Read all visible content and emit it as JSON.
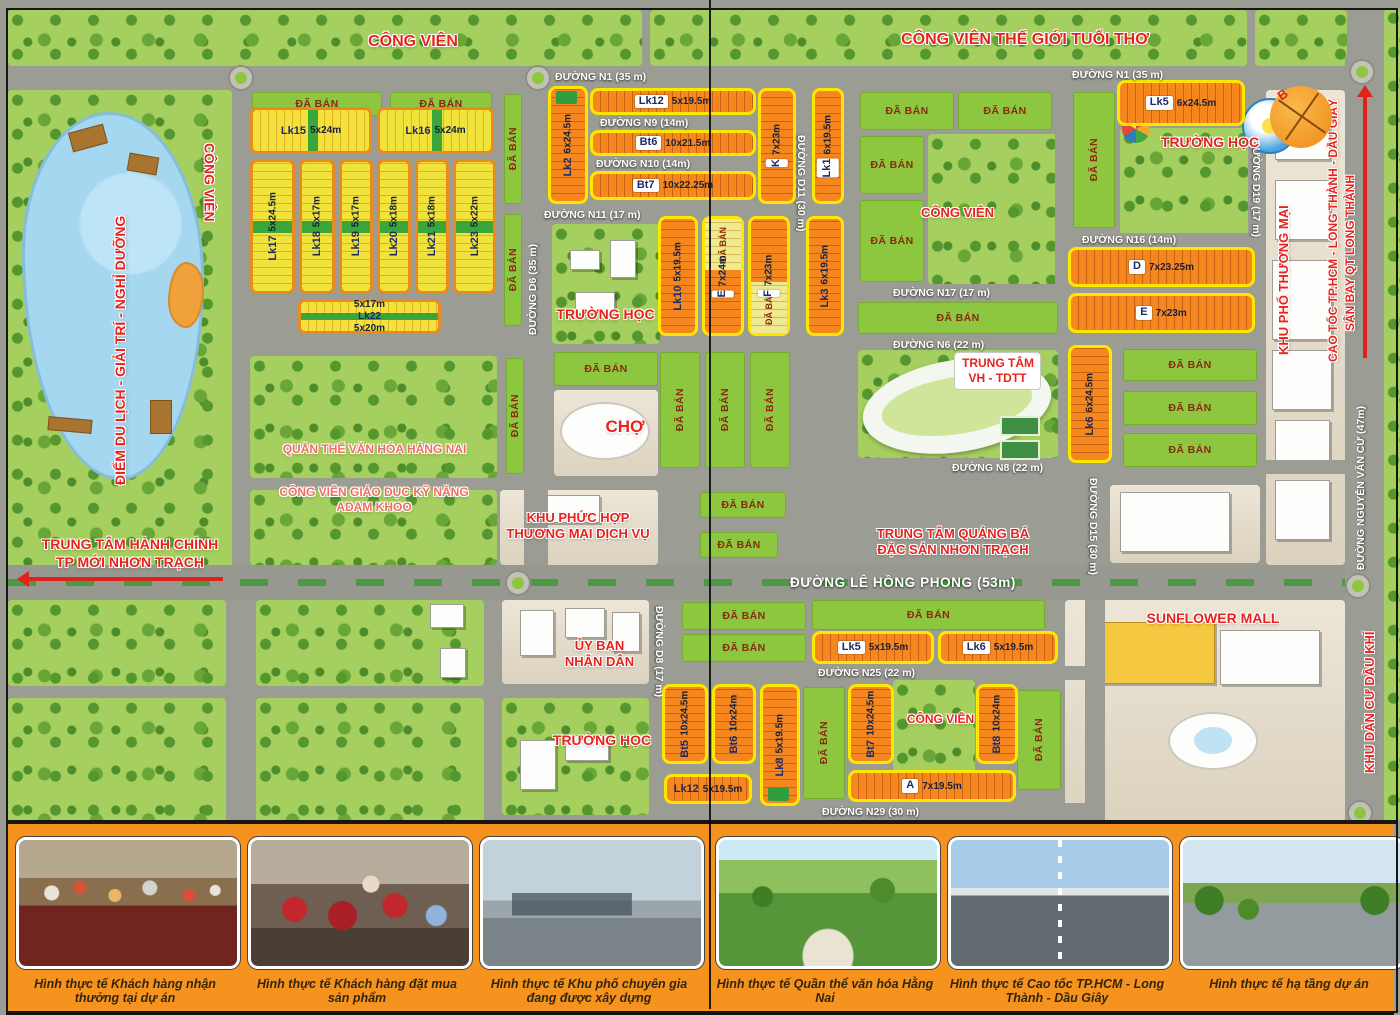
{
  "legend": {
    "sold": "ĐÃ BÁN"
  },
  "compass": {
    "letter": "B"
  },
  "colors": {
    "road": "#9b9c93",
    "sold_green": "#8dc63f",
    "lot_orange": "#f6871f",
    "lot_yellow": "#f2e23c",
    "border_yellow": "#ffe600",
    "border_orange": "#e98c1d",
    "label_red": "#e8231d",
    "water": "#a5d7f0",
    "strip_orange": "#f6921e"
  },
  "roads": [
    {
      "id": "n1",
      "label": "ĐƯỜNG N1 (35 m)",
      "x": 8,
      "y": 66,
      "w": 1337,
      "h": 24,
      "lx": 555,
      "ly": 71,
      "l2x": 1072,
      "l2y": 69
    },
    {
      "id": "d6",
      "label": "ĐƯỜNG D6 (35 m)",
      "x": 524,
      "y": 90,
      "w": 24,
      "h": 475,
      "lx": 527,
      "ly": 215,
      "lh": 120,
      "lvert": "up"
    },
    {
      "id": "d11-top",
      "label": "ĐƯỜNG D11 (30 m)",
      "x": 794,
      "y": 90,
      "w": 16,
      "h": 475,
      "lx": 795,
      "ly": 135,
      "lh": 115,
      "lvert": "down"
    },
    {
      "id": "left-v",
      "x": 232,
      "y": 66,
      "w": 18,
      "h": 534
    },
    {
      "id": "mid-v",
      "x": 845,
      "y": 90,
      "w": 13,
      "h": 475
    },
    {
      "id": "right-v1",
      "x": 1055,
      "y": 90,
      "w": 16,
      "h": 255
    },
    {
      "id": "d15",
      "label": "ĐƯỜNG D15 (30 m)",
      "x": 1085,
      "y": 345,
      "w": 20,
      "h": 255,
      "lx": 1087,
      "ly": 478,
      "lh": 112,
      "lvert": "down"
    },
    {
      "id": "d19",
      "label": "ĐƯỜNG D19 (17 m)",
      "x": 1248,
      "y": 66,
      "w": 18,
      "h": 170,
      "lx": 1250,
      "ly": 140,
      "lh": 95,
      "lvert": "down"
    },
    {
      "id": "nguyen-van-cu",
      "label": "ĐƯỜNG NGUYỄN VĂN CỪ (47m)",
      "x": 1345,
      "y": 56,
      "w": 37,
      "h": 766,
      "lx": 1355,
      "ly": 360,
      "lh": 210,
      "lvert": "up"
    },
    {
      "id": "n9",
      "label": "ĐƯỜNG N9 (14m)",
      "x": 588,
      "y": 117,
      "w": 168,
      "h": 11,
      "lx": 600,
      "ly": 117
    },
    {
      "id": "n10",
      "label": "ĐƯỜNG N10 (14m)",
      "x": 588,
      "y": 158,
      "w": 168,
      "h": 11,
      "lx": 596,
      "ly": 158
    },
    {
      "id": "n11",
      "label": "ĐƯỜNG N11 (17 m)",
      "x": 524,
      "y": 208,
      "w": 334,
      "h": 13,
      "lx": 544,
      "ly": 209
    },
    {
      "id": "n16",
      "label": "ĐƯỜNG N16 (14m)",
      "x": 1068,
      "y": 233,
      "w": 180,
      "h": 12,
      "lx": 1082,
      "ly": 234
    },
    {
      "id": "n17",
      "label": "ĐƯỜNG N17 (17 m)",
      "x": 858,
      "y": 286,
      "w": 200,
      "h": 12,
      "lx": 893,
      "ly": 287
    },
    {
      "id": "n6",
      "label": "ĐƯỜNG N6 (22 m)",
      "x": 858,
      "y": 338,
      "w": 230,
      "h": 12,
      "lx": 893,
      "ly": 339
    },
    {
      "id": "n8",
      "label": "ĐƯỜNG N8 (22 m)",
      "x": 858,
      "y": 460,
      "w": 487,
      "h": 14,
      "lx": 952,
      "ly": 462
    },
    {
      "id": "mid-h",
      "x": 232,
      "y": 478,
      "w": 626,
      "h": 12
    },
    {
      "id": "le-hong-phong",
      "label": "ĐƯỜNG LÊ HỒNG PHONG  (53m)",
      "x": 8,
      "y": 565,
      "w": 1337,
      "h": 35,
      "lx": 790,
      "ly": 575,
      "big": true
    },
    {
      "id": "n25",
      "label": "ĐƯỜNG N25 (22 m)",
      "x": 652,
      "y": 666,
      "w": 433,
      "h": 14,
      "lx": 818,
      "ly": 667
    },
    {
      "id": "n29",
      "label": "ĐƯỜNG N29 (30 m)",
      "x": 652,
      "y": 803,
      "w": 433,
      "h": 17,
      "lx": 822,
      "ly": 806
    },
    {
      "id": "d8",
      "label": "ĐƯỜNG D8 (17 m)",
      "x": 650,
      "y": 600,
      "w": 24,
      "h": 222,
      "lx": 653,
      "ly": 606,
      "lh": 100,
      "lvert": "down"
    },
    {
      "id": "bl-h",
      "x": 8,
      "y": 686,
      "w": 644,
      "h": 12
    },
    {
      "id": "bl-v1",
      "x": 230,
      "y": 600,
      "w": 16,
      "h": 222
    },
    {
      "id": "bl-v2",
      "x": 488,
      "y": 600,
      "w": 14,
      "h": 222
    },
    {
      "id": "mall-left-v",
      "x": 1085,
      "y": 600,
      "w": 20,
      "h": 222
    }
  ],
  "parks": [
    {
      "id": "top-left",
      "x": 8,
      "y": 10,
      "w": 634,
      "h": 56
    },
    {
      "id": "top-mid",
      "x": 650,
      "y": 10,
      "w": 597,
      "h": 56
    },
    {
      "id": "top-right",
      "x": 1255,
      "y": 10,
      "w": 92,
      "h": 56
    },
    {
      "id": "lake-park",
      "x": 8,
      "y": 90,
      "w": 224,
      "h": 510
    },
    {
      "id": "school-mid",
      "x": 552,
      "y": 224,
      "w": 108,
      "h": 120
    },
    {
      "id": "quan-the",
      "x": 250,
      "y": 356,
      "w": 247,
      "h": 122
    },
    {
      "id": "adam-khoo",
      "x": 250,
      "y": 490,
      "w": 247,
      "h": 75
    },
    {
      "id": "central-cong-vien",
      "x": 928,
      "y": 134,
      "w": 130,
      "h": 150
    },
    {
      "id": "school-right",
      "x": 1120,
      "y": 128,
      "w": 132,
      "h": 107
    },
    {
      "id": "vh-tdtt",
      "x": 858,
      "y": 350,
      "w": 200,
      "h": 108
    },
    {
      "id": "bl-a",
      "x": 8,
      "y": 600,
      "w": 218,
      "h": 86
    },
    {
      "id": "bl-b",
      "x": 8,
      "y": 698,
      "w": 218,
      "h": 124
    },
    {
      "id": "bl-c",
      "x": 256,
      "y": 600,
      "w": 228,
      "h": 86
    },
    {
      "id": "bl-d",
      "x": 256,
      "y": 698,
      "w": 228,
      "h": 124
    },
    {
      "id": "school-bottom",
      "x": 502,
      "y": 698,
      "w": 147,
      "h": 117
    },
    {
      "id": "cong-vien-bottom",
      "x": 893,
      "y": 680,
      "w": 82,
      "h": 92
    },
    {
      "id": "east-edge",
      "x": 1384,
      "y": 8,
      "w": 16,
      "h": 814
    }
  ],
  "plazas": [
    {
      "id": "cho",
      "x": 554,
      "y": 390,
      "w": 104,
      "h": 86
    },
    {
      "id": "khu-phuc-hop",
      "x": 500,
      "y": 490,
      "w": 158,
      "h": 75
    },
    {
      "id": "uy-ban",
      "x": 502,
      "y": 600,
      "w": 147,
      "h": 84
    },
    {
      "id": "sunflower",
      "x": 1065,
      "y": 600,
      "w": 280,
      "h": 222
    },
    {
      "id": "shophouse-strip",
      "x": 1266,
      "y": 90,
      "w": 79,
      "h": 475
    },
    {
      "id": "office-block",
      "x": 1110,
      "y": 485,
      "w": 150,
      "h": 78
    }
  ],
  "buildings": [
    {
      "x": 570,
      "y": 250,
      "w": 30,
      "h": 20
    },
    {
      "x": 610,
      "y": 240,
      "w": 26,
      "h": 38
    },
    {
      "x": 575,
      "y": 292,
      "w": 40,
      "h": 22
    },
    {
      "x": 540,
      "y": 495,
      "w": 60,
      "h": 28
    },
    {
      "x": 520,
      "y": 610,
      "w": 34,
      "h": 46
    },
    {
      "x": 565,
      "y": 608,
      "w": 40,
      "h": 30
    },
    {
      "x": 612,
      "y": 612,
      "w": 28,
      "h": 40
    },
    {
      "x": 520,
      "y": 740,
      "w": 36,
      "h": 50
    },
    {
      "x": 565,
      "y": 735,
      "w": 44,
      "h": 26
    },
    {
      "x": 1120,
      "y": 492,
      "w": 110,
      "h": 60
    },
    {
      "x": 1275,
      "y": 120,
      "w": 55,
      "h": 40
    },
    {
      "x": 1275,
      "y": 180,
      "w": 55,
      "h": 60
    },
    {
      "x": 1272,
      "y": 260,
      "w": 60,
      "h": 80
    },
    {
      "x": 1272,
      "y": 350,
      "w": 60,
      "h": 60
    },
    {
      "x": 1275,
      "y": 420,
      "w": 55,
      "h": 50
    },
    {
      "x": 1275,
      "y": 480,
      "w": 55,
      "h": 60
    },
    {
      "x": 1090,
      "y": 622,
      "w": 125,
      "h": 62,
      "kind": "mall"
    },
    {
      "x": 1220,
      "y": 630,
      "w": 100,
      "h": 55
    },
    {
      "x": 430,
      "y": 604,
      "w": 34,
      "h": 24
    },
    {
      "x": 440,
      "y": 648,
      "w": 26,
      "h": 30
    }
  ],
  "roundabouts": [
    {
      "x": 241,
      "y": 78
    },
    {
      "x": 538,
      "y": 78
    },
    {
      "x": 1362,
      "y": 72
    },
    {
      "x": 518,
      "y": 583
    },
    {
      "x": 1358,
      "y": 586
    },
    {
      "x": 1360,
      "y": 813
    }
  ],
  "sold_blocks": [
    {
      "x": 252,
      "y": 92,
      "w": 130,
      "h": 24
    },
    {
      "x": 390,
      "y": 92,
      "w": 102,
      "h": 24
    },
    {
      "x": 504,
      "y": 94,
      "w": 18,
      "h": 110,
      "v": true
    },
    {
      "x": 504,
      "y": 214,
      "w": 18,
      "h": 112,
      "v": true
    },
    {
      "x": 860,
      "y": 92,
      "w": 94,
      "h": 38
    },
    {
      "x": 958,
      "y": 92,
      "w": 94,
      "h": 38
    },
    {
      "x": 860,
      "y": 136,
      "w": 64,
      "h": 58
    },
    {
      "x": 860,
      "y": 200,
      "w": 64,
      "h": 82
    },
    {
      "x": 858,
      "y": 302,
      "w": 200,
      "h": 32
    },
    {
      "x": 1073,
      "y": 92,
      "w": 42,
      "h": 136,
      "v": true
    },
    {
      "x": 1123,
      "y": 349,
      "w": 134,
      "h": 32
    },
    {
      "x": 1123,
      "y": 391,
      "w": 134,
      "h": 34
    },
    {
      "x": 1123,
      "y": 433,
      "w": 134,
      "h": 34
    },
    {
      "x": 700,
      "y": 492,
      "w": 86,
      "h": 26
    },
    {
      "x": 700,
      "y": 532,
      "w": 78,
      "h": 26
    },
    {
      "x": 660,
      "y": 352,
      "w": 40,
      "h": 116,
      "v": true
    },
    {
      "x": 705,
      "y": 352,
      "w": 40,
      "h": 116,
      "v": true
    },
    {
      "x": 750,
      "y": 352,
      "w": 40,
      "h": 116,
      "v": true
    },
    {
      "x": 812,
      "y": 600,
      "w": 233,
      "h": 30
    },
    {
      "x": 682,
      "y": 602,
      "w": 124,
      "h": 28
    },
    {
      "x": 682,
      "y": 634,
      "w": 124,
      "h": 28
    },
    {
      "x": 803,
      "y": 687,
      "w": 42,
      "h": 112,
      "v": true
    },
    {
      "x": 1017,
      "y": 690,
      "w": 44,
      "h": 100,
      "v": true
    },
    {
      "x": 554,
      "y": 352,
      "w": 104,
      "h": 34
    },
    {
      "x": 506,
      "y": 358,
      "w": 18,
      "h": 116,
      "v": true
    }
  ],
  "lots": [
    {
      "name": "Lk15",
      "dim": "5x24m",
      "style": "a",
      "x": 250,
      "y": 107,
      "w": 122,
      "h": 47
    },
    {
      "name": "Lk16",
      "dim": "5x24m",
      "style": "a",
      "x": 377,
      "y": 107,
      "w": 117,
      "h": 47
    },
    {
      "name": "Lk17",
      "dim": "5x24.5m",
      "style": "a",
      "v": true,
      "x": 250,
      "y": 159,
      "w": 45,
      "h": 135
    },
    {
      "name": "Lk18",
      "dim": "5x17m",
      "style": "a",
      "v": true,
      "x": 299,
      "y": 159,
      "w": 36,
      "h": 135
    },
    {
      "name": "Lk19",
      "dim": "5x17m",
      "style": "a",
      "v": true,
      "x": 339,
      "y": 159,
      "w": 34,
      "h": 135
    },
    {
      "name": "Lk20",
      "dim": "5x18m",
      "style": "a",
      "v": true,
      "x": 377,
      "y": 159,
      "w": 34,
      "h": 135
    },
    {
      "name": "Lk21",
      "dim": "5x18m",
      "style": "a",
      "v": true,
      "x": 415,
      "y": 159,
      "w": 34,
      "h": 135
    },
    {
      "name": "Lk23",
      "dim": "5x22m",
      "style": "a",
      "v": true,
      "x": 453,
      "y": 159,
      "w": 43,
      "h": 135
    },
    {
      "name": "Lk22",
      "dim": "5x17m",
      "dim2": "5x20m",
      "style": "a",
      "bandh": true,
      "x": 298,
      "y": 299,
      "w": 143,
      "h": 35
    },
    {
      "name": "Lk2",
      "dim": "6x24.5m",
      "style": "b",
      "v": true,
      "cap": "top",
      "x": 548,
      "y": 86,
      "w": 40,
      "h": 118
    },
    {
      "name": "Lk12",
      "dim": "5x19.5m",
      "style": "b",
      "chip": true,
      "x": 590,
      "y": 88,
      "w": 166,
      "h": 27
    },
    {
      "name": "Bt6",
      "dim": "10x21.5m",
      "style": "b",
      "chip": true,
      "x": 590,
      "y": 130,
      "w": 166,
      "h": 26
    },
    {
      "name": "Bt7",
      "dim": "10x22.25m",
      "style": "b",
      "chip": true,
      "x": 590,
      "y": 171,
      "w": 166,
      "h": 29
    },
    {
      "name": "K",
      "dim": "7x23m",
      "style": "b",
      "chip": true,
      "v": true,
      "x": 758,
      "y": 88,
      "w": 38,
      "h": 116
    },
    {
      "name": "Lk1",
      "dim": "6x19.5m",
      "style": "b",
      "chip": true,
      "v": true,
      "x": 812,
      "y": 88,
      "w": 32,
      "h": 116
    },
    {
      "name": "Lk5",
      "dim": "6x24.5m",
      "style": "b",
      "chip": true,
      "x": 1117,
      "y": 80,
      "w": 128,
      "h": 46
    },
    {
      "name": "Lk10",
      "dim": "5x19.5m",
      "style": "b",
      "v": true,
      "x": 658,
      "y": 216,
      "w": 40,
      "h": 120
    },
    {
      "name": "E",
      "dim": "7x24m",
      "style": "b",
      "chip": true,
      "v": true,
      "sold": "top",
      "x": 702,
      "y": 216,
      "w": 42,
      "h": 120
    },
    {
      "name": "F",
      "dim": "7x23m",
      "style": "b",
      "chip": true,
      "v": true,
      "sold": "bottom",
      "x": 748,
      "y": 216,
      "w": 42,
      "h": 120
    },
    {
      "name": "Lk3",
      "dim": "6x19.5m",
      "style": "b",
      "v": true,
      "x": 806,
      "y": 216,
      "w": 38,
      "h": 120
    },
    {
      "name": "D",
      "dim": "7x23.25m",
      "style": "b",
      "chip": true,
      "x": 1068,
      "y": 247,
      "w": 187,
      "h": 40
    },
    {
      "name": "E",
      "dim": "7x23m",
      "style": "b",
      "chip": true,
      "x": 1068,
      "y": 293,
      "w": 187,
      "h": 40
    },
    {
      "name": "Lk6",
      "dim": "6x24.5m",
      "style": "b",
      "v": true,
      "x": 1068,
      "y": 345,
      "w": 44,
      "h": 118
    },
    {
      "name": "Lk5",
      "dim": "5x19.5m",
      "style": "b",
      "chip": true,
      "x": 812,
      "y": 631,
      "w": 122,
      "h": 33
    },
    {
      "name": "Lk6",
      "dim": "5x19.5m",
      "style": "b",
      "chip": true,
      "x": 938,
      "y": 631,
      "w": 120,
      "h": 33
    },
    {
      "name": "Bt5",
      "dim": "10x24.5m",
      "style": "b",
      "v": true,
      "x": 662,
      "y": 684,
      "w": 46,
      "h": 80
    },
    {
      "name": "Bt6",
      "dim": "10x24m",
      "style": "b",
      "v": true,
      "x": 712,
      "y": 684,
      "w": 44,
      "h": 80
    },
    {
      "name": "Lk8",
      "dim": "5x19.5m",
      "style": "b",
      "v": true,
      "cap": "bottom",
      "x": 760,
      "y": 684,
      "w": 40,
      "h": 122
    },
    {
      "name": "Lk12",
      "dim": "5x19.5m",
      "style": "b",
      "x": 664,
      "y": 774,
      "w": 88,
      "h": 30
    },
    {
      "name": "Bt7",
      "dim": "10x24.5m",
      "style": "b",
      "v": true,
      "x": 848,
      "y": 684,
      "w": 46,
      "h": 80
    },
    {
      "name": "Bt8",
      "dim": "10x24m",
      "style": "b",
      "v": true,
      "x": 976,
      "y": 684,
      "w": 42,
      "h": 80
    },
    {
      "name": "A",
      "dim": "7x19.5m",
      "style": "b",
      "chip": true,
      "x": 848,
      "y": 770,
      "w": 168,
      "h": 32
    }
  ],
  "labels": [
    {
      "id": "cong-vien-top-left",
      "text": "CÔNG VIÊN",
      "x": 348,
      "y": 32,
      "w": 130,
      "size": 16
    },
    {
      "id": "cong-vien-the-gioi-tuoi-tho",
      "text": "CÔNG VIÊN THẾ GIỚI TUỔI THƠ",
      "x": 880,
      "y": 30,
      "w": 290,
      "size": 16
    },
    {
      "id": "truong-hoc-right",
      "text": "TRƯỜNG HỌC",
      "x": 1155,
      "y": 134,
      "w": 110,
      "size": 14
    },
    {
      "id": "cong-vien-left",
      "text": "CÔNG VIÊN",
      "x": 200,
      "y": 95,
      "h": 175,
      "size": 14,
      "vert": "down"
    },
    {
      "id": "diem-du-lich",
      "text": "ĐIỂM DU LỊCH - GIẢI TRÍ - NGHỈ DƯỠNG",
      "x": 112,
      "y": 185,
      "h": 330,
      "size": 14,
      "vert": "up"
    },
    {
      "id": "trung-tam-hanh-chinh",
      "lines": [
        "TRUNG TÂM HÀNH CHÍNH",
        "TP MỚI NHƠN TRẠCH"
      ],
      "x": 25,
      "y": 536,
      "w": 210,
      "size": 14
    },
    {
      "id": "truong-hoc-mid",
      "text": "TRƯỜNG HỌC",
      "x": 548,
      "y": 306,
      "w": 115,
      "size": 14
    },
    {
      "id": "cho",
      "text": "CHỢ",
      "x": 585,
      "y": 416,
      "w": 80,
      "size": 17
    },
    {
      "id": "cong-vien-center",
      "text": "CÔNG VIÊN",
      "x": 905,
      "y": 205,
      "w": 105,
      "size": 13
    },
    {
      "id": "trung-tam-vh-tdtt",
      "lines": [
        "TRUNG TÂM",
        "VH - TDTT"
      ],
      "x": 955,
      "y": 353,
      "w": 85,
      "size": 12,
      "boxed": true
    },
    {
      "id": "quan-the-van-hoa",
      "text": "QUẦN THỂ VĂN HÓA HẰNG NAI",
      "x": 252,
      "y": 442,
      "w": 245,
      "size": 12,
      "kind": "pink"
    },
    {
      "id": "adam-khoo",
      "lines": [
        "CÔNG VIÊN GIÁO DỤC KỸ NĂNG",
        "ADAM KHOO"
      ],
      "x": 248,
      "y": 485,
      "w": 252,
      "size": 12,
      "kind": "pink"
    },
    {
      "id": "khu-phuc-hop",
      "lines": [
        "KHU PHỨC HỢP",
        "THƯƠNG MẠI DỊCH VỤ"
      ],
      "x": 492,
      "y": 510,
      "w": 172,
      "size": 13
    },
    {
      "id": "trung-tam-quang-ba",
      "lines": [
        "TRUNG TÂM QUẢNG BÁ",
        "ĐẶC SẢN NHƠN TRẠCH"
      ],
      "x": 848,
      "y": 526,
      "w": 210,
      "size": 13
    },
    {
      "id": "uy-ban-nhan-dan",
      "lines": [
        "ỦY BAN",
        "NHÂN DÂN"
      ],
      "x": 542,
      "y": 638,
      "w": 115,
      "size": 13
    },
    {
      "id": "truong-hoc-bottom",
      "text": "TRƯỜNG HỌC",
      "x": 542,
      "y": 732,
      "w": 120,
      "size": 14
    },
    {
      "id": "sunflower-mall",
      "text": "SUNFLOWER MALL",
      "x": 1128,
      "y": 610,
      "w": 170,
      "size": 14
    },
    {
      "id": "khu-pho-thuong-mai",
      "text": "KHU PHỐ THƯƠNG MẠI",
      "x": 1276,
      "y": 210,
      "h": 145,
      "size": 13,
      "vert": "up"
    },
    {
      "id": "cao-toc",
      "text": "CAO TỐC TP.HCM - LONG THÀNH - DẦU GIÂY",
      "x": 1326,
      "y": 85,
      "h": 290,
      "size": 12,
      "vert": "up"
    },
    {
      "id": "san-bay",
      "text": "SÂN BAY QT LONG THÀNH",
      "x": 1343,
      "y": 130,
      "h": 245,
      "size": 12,
      "vert": "up"
    },
    {
      "id": "khu-dan-cu-dau-khi",
      "text": "KHU DÂN CƯ DẦU KHÍ",
      "x": 1362,
      "y": 610,
      "h": 185,
      "size": 13,
      "vert": "up"
    },
    {
      "id": "cong-vien-bottom",
      "text": "CÔNG VIÊN",
      "x": 893,
      "y": 712,
      "w": 95,
      "size": 12
    }
  ],
  "strip": {
    "photos": [
      {
        "kind": "k1",
        "caption": "Hình thực tế Khách hàng nhận thưởng tại dự án"
      },
      {
        "kind": "k2",
        "caption": "Hình thực tế Khách hàng đặt mua sản phẩm"
      },
      {
        "kind": "k3",
        "caption": "Hình thực tế Khu phố chuyên gia đang được xây dựng"
      },
      {
        "kind": "k4",
        "caption": "Hình thực tế Quần thể văn hóa Hằng Nai"
      },
      {
        "kind": "k5",
        "caption": "Hình thực tế Cao tốc TP.HCM - Long Thành - Dầu Giây"
      },
      {
        "kind": "k6",
        "caption": "Hình thực tế hạ tầng dự án"
      }
    ]
  }
}
